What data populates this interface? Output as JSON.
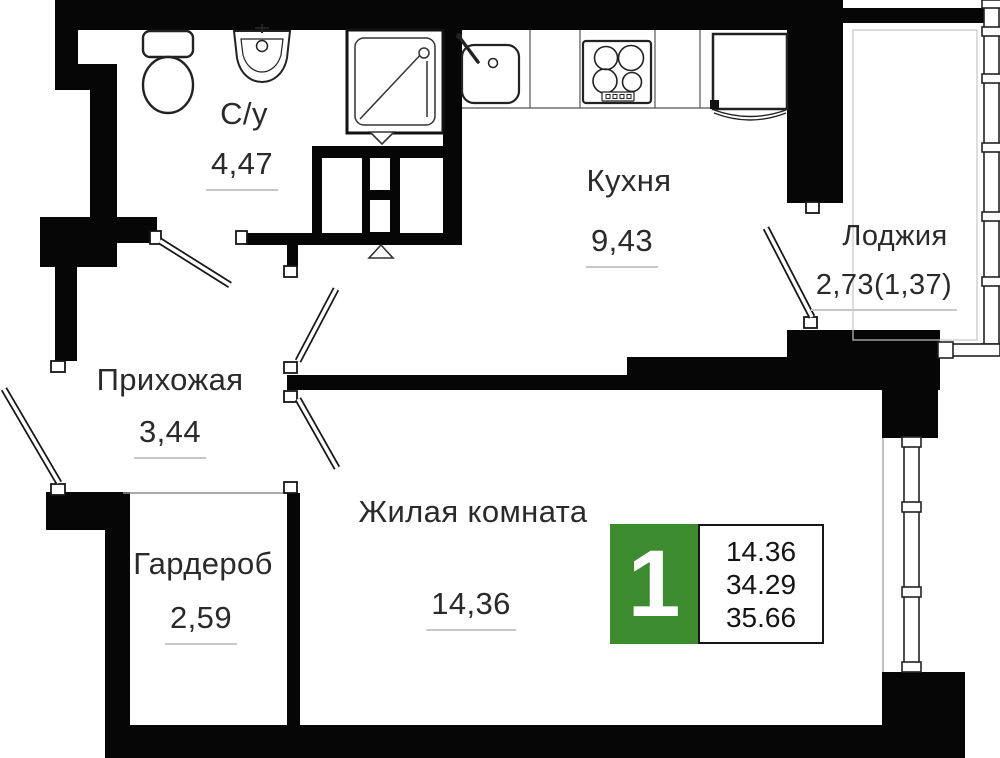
{
  "rooms": {
    "bathroom": {
      "label": "С/у",
      "area": "4,47"
    },
    "kitchen": {
      "label": "Кухня",
      "area": "9,43"
    },
    "loggia": {
      "label": "Лоджия",
      "area": "2,73(1,37)"
    },
    "hallway": {
      "label": "Прихожая",
      "area": "3,44"
    },
    "wardrobe": {
      "label": "Гардероб",
      "area": "2,59"
    },
    "living_room": {
      "label": "Жилая комната",
      "area": "14,36"
    }
  },
  "info_badge": {
    "rooms_count": "1",
    "living_area": "14.36",
    "apartment_area": "34.29",
    "total_area": "35.66"
  },
  "colors": {
    "wall": "#060606",
    "badge_green": "#3c8b2e",
    "underline": "#c7c7c7"
  }
}
